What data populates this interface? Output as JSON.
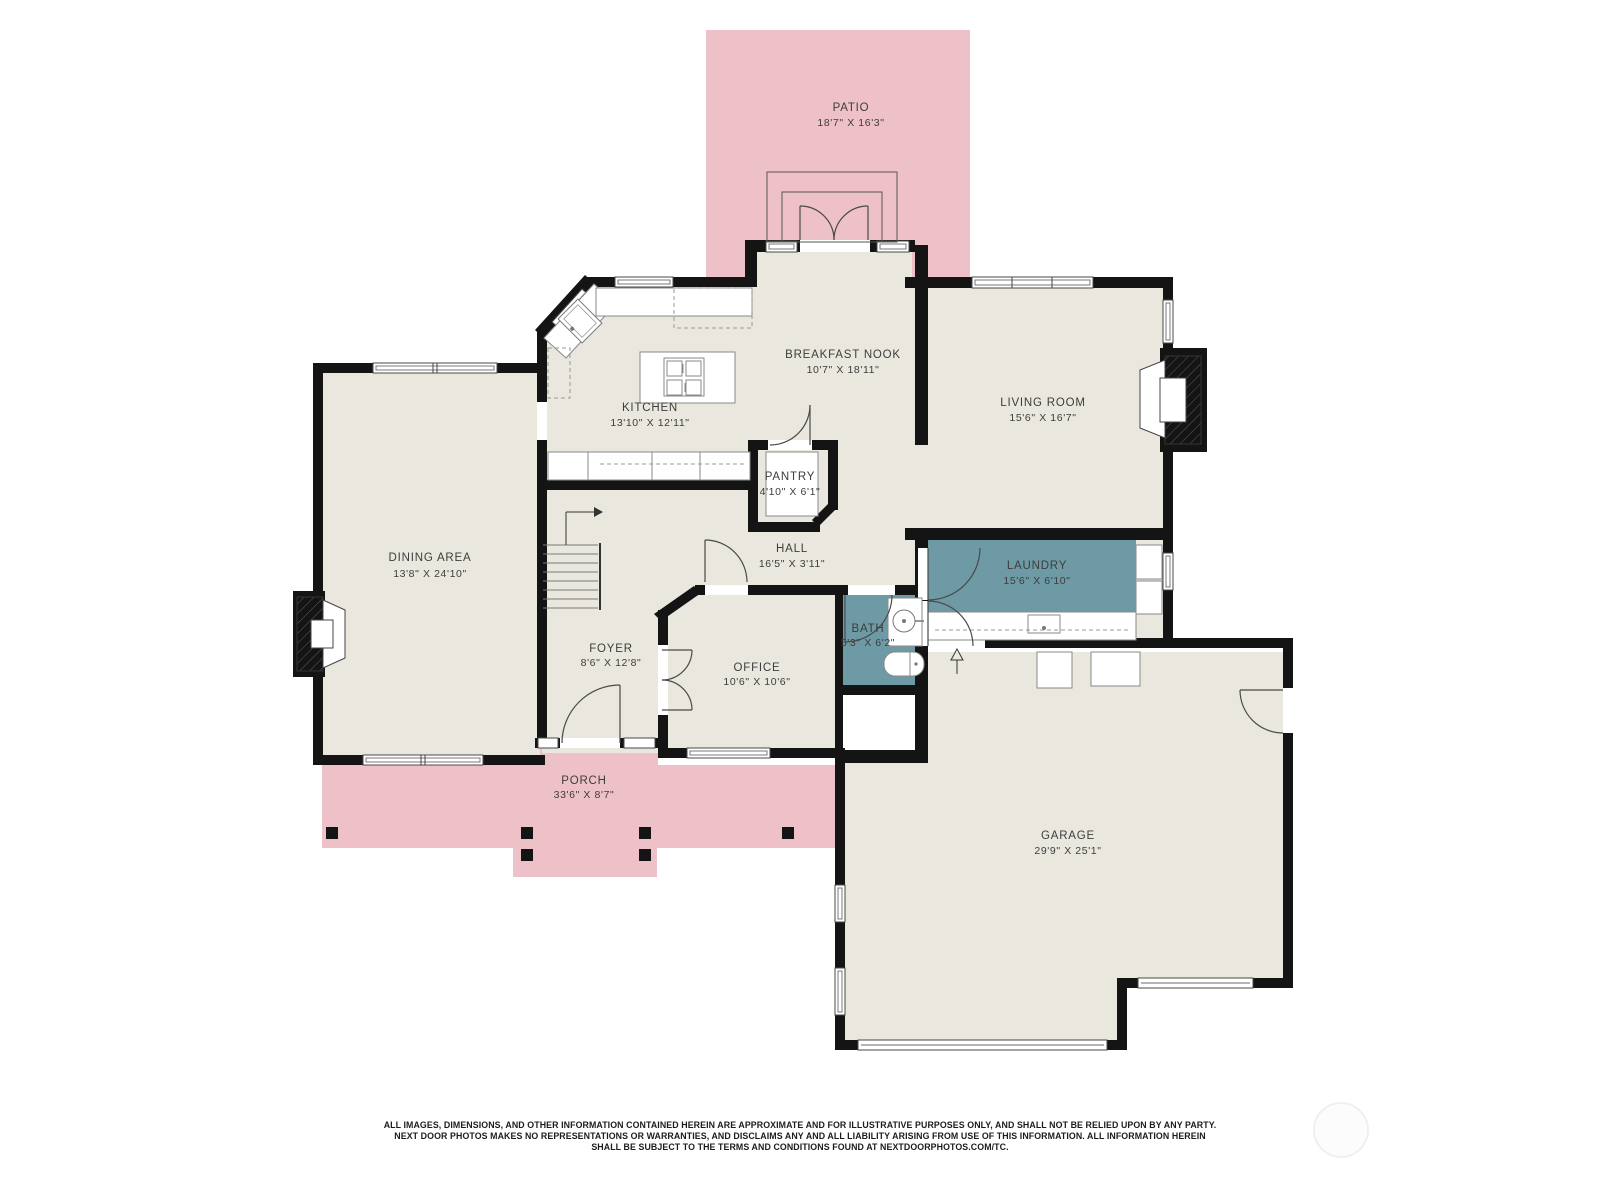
{
  "title": "First floor plan",
  "colors": {
    "wall": "#141414",
    "floor_beige": "#e9e7de",
    "outdoor_pink": "#edc1c7",
    "wet_room_teal": "#6d9aa4"
  },
  "rooms": [
    {
      "id": "patio",
      "name": "PATIO",
      "dims": "18'7\" X 16'3\""
    },
    {
      "id": "breakfast_nook",
      "name": "BREAKFAST NOOK",
      "dims": "10'7\" X 18'11\""
    },
    {
      "id": "kitchen",
      "name": "KITCHEN",
      "dims": "13'10\" X 12'11\""
    },
    {
      "id": "living_room",
      "name": "LIVING ROOM",
      "dims": "15'6\" X 16'7\""
    },
    {
      "id": "pantry",
      "name": "PANTRY",
      "dims": "4'10\" X 6'1\""
    },
    {
      "id": "dining_area",
      "name": "DINING AREA",
      "dims": "13'8\" X 24'10\""
    },
    {
      "id": "hall",
      "name": "HALL",
      "dims": "16'5\" X 3'11\""
    },
    {
      "id": "laundry",
      "name": "LAUNDRY",
      "dims": "15'6\" X 6'10\""
    },
    {
      "id": "bath",
      "name": "BATH",
      "dims": "5'3\" X 6'2\""
    },
    {
      "id": "foyer",
      "name": "FOYER",
      "dims": "8'6\" X 12'8\""
    },
    {
      "id": "office",
      "name": "OFFICE",
      "dims": "10'6\" X 10'6\""
    },
    {
      "id": "porch",
      "name": "PORCH",
      "dims": "33'6\" X 8'7\""
    },
    {
      "id": "garage",
      "name": "GARAGE",
      "dims": "29'9\" X 25'1\""
    }
  ],
  "disclaimer": {
    "line1": "ALL IMAGES, DIMENSIONS, AND OTHER INFORMATION CONTAINED HEREIN ARE APPROXIMATE AND FOR ILLUSTRATIVE PURPOSES ONLY, AND SHALL NOT BE RELIED UPON BY ANY PARTY.",
    "line2": "NEXT DOOR PHOTOS MAKES NO REPRESENTATIONS OR WARRANTIES, AND DISCLAIMS ANY AND ALL LIABILITY ARISING FROM USE OF THIS INFORMATION. ALL INFORMATION HEREIN",
    "line3": "SHALL BE SUBJECT TO THE TERMS AND CONDITIONS FOUND AT NEXTDOORPHOTOS.COM/TC."
  }
}
